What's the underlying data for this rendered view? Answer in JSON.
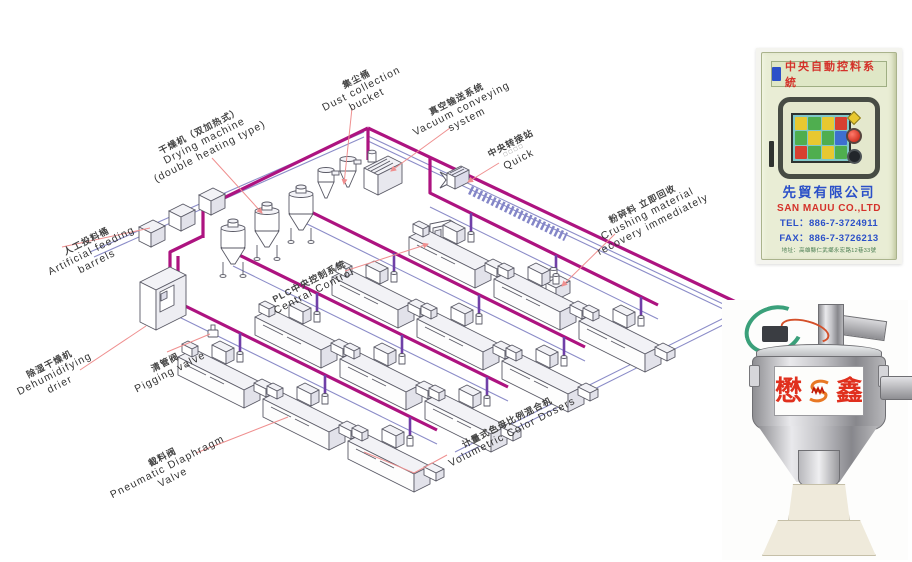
{
  "diagram": {
    "labels": {
      "drying_machine": {
        "lines": [
          "干燥机（双加热式）",
          "Drying machine",
          "(double heating type)"
        ]
      },
      "dust_collection": {
        "lines": [
          "集尘桶",
          "Dust collection",
          "bucket"
        ]
      },
      "vacuum_conveying": {
        "lines": [
          "真空输送系统",
          "Vacuum conveying",
          "system"
        ]
      },
      "central_transfer": {
        "lines": [
          "中央转接站",
          "□□□□",
          "Quick"
        ]
      },
      "crushing": {
        "lines": [
          "粉碎料 立即回收",
          "Crushing material",
          "recovery immediately"
        ]
      },
      "artificial_feeding": {
        "lines": [
          "人工投料桶",
          "Artificial feeding",
          "barrels"
        ]
      },
      "dehumidifying": {
        "lines": [
          "除湿干燥机",
          "Dehumidifying",
          "drier"
        ]
      },
      "pigging_valve": {
        "lines": [
          "清管阀",
          "Pigging valve"
        ]
      },
      "plc_control": {
        "lines": [
          "PLC中央控制系统",
          "Central Control"
        ]
      },
      "pneumatic_valve": {
        "lines": [
          "截料阀",
          "Pneumatic Diaphragm",
          "Valve"
        ]
      },
      "volumetric_dosers": {
        "lines": [
          "计量式色母比例混合机",
          "Volumetric Color Dosers"
        ]
      }
    },
    "colors": {
      "pipe_magenta": "#ad1380",
      "drop_violet": "#7040a8",
      "line_blue": "#8b8cc8",
      "leader_red": "#ef8f8f",
      "outline_gray": "#5a5a66"
    }
  },
  "control_cabinet": {
    "header": "中央自動控料系統",
    "company_cn": "先貿有限公司",
    "company_en": "SAN MAUU CO.,LTD",
    "tel": "TEL：886-7-3724911",
    "fax": "FAX：886-7-3726213",
    "address": "地址：高雄縣仁武鄉永宏路12巷33號",
    "colors": {
      "body": "#e9edd5",
      "header_text_red": "#d4322a",
      "text_blue": "#2b50c8",
      "screen_teal": "#7fc8c8"
    }
  },
  "hopper_loader": {
    "brand_left": "懋",
    "brand_right": "鑫",
    "brand_color": "#e0301e"
  }
}
